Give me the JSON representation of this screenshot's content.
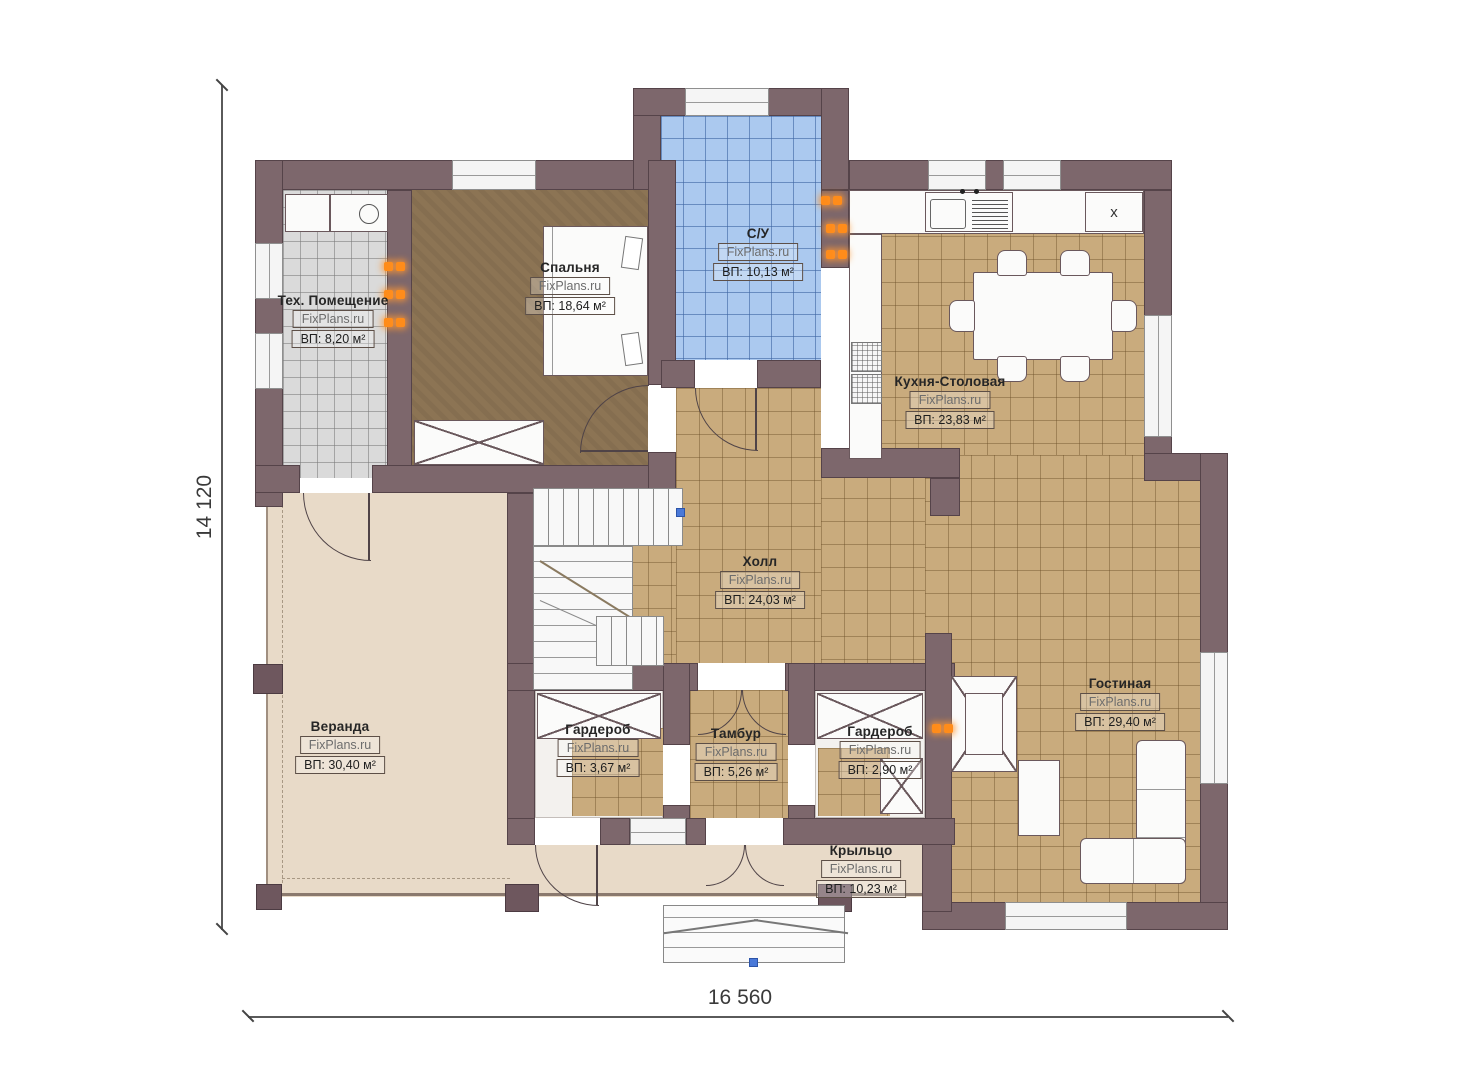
{
  "site_watermark": "FixPlans.ru",
  "dimensions": {
    "vertical": "14 120",
    "horizontal": "16 560"
  },
  "kitchen": {
    "hob_label": "x"
  },
  "rooms": [
    {
      "name": "Тех. Помещение",
      "area": "ВП: 8,20 м²",
      "x": 333,
      "y": 293
    },
    {
      "name": "Спальня",
      "area": "ВП: 18,64 м²",
      "x": 570,
      "y": 260
    },
    {
      "name": "С/У",
      "area": "ВП: 10,13 м²",
      "x": 758,
      "y": 226
    },
    {
      "name": "Кухня-Столовая",
      "area": "ВП: 23,83 м²",
      "x": 950,
      "y": 374
    },
    {
      "name": "Холл",
      "area": "ВП: 24,03 м²",
      "x": 760,
      "y": 554
    },
    {
      "name": "Веранда",
      "area": "ВП: 30,40 м²",
      "x": 340,
      "y": 719
    },
    {
      "name": "Гардероб",
      "area": "ВП: 3,67 м²",
      "x": 598,
      "y": 722
    },
    {
      "name": "Тамбур",
      "area": "ВП: 5,26 м²",
      "x": 736,
      "y": 726
    },
    {
      "name": "Гардероб",
      "area": "ВП: 2,90 м²",
      "x": 880,
      "y": 724
    },
    {
      "name": "Гостиная",
      "area": "ВП: 29,40 м²",
      "x": 1120,
      "y": 676
    },
    {
      "name": "Крыльцо",
      "area": "ВП: 10,23 м²",
      "x": 861,
      "y": 843
    }
  ],
  "colors": {
    "wall": "#7d676c",
    "floor_tile": "#c9ab7d",
    "floor_bath": "#abc9ef",
    "floor_bedroom": "#8c7454",
    "floor_tech": "#dadada",
    "floor_terrace": "#e8dac8",
    "indicator": "#ff8c1a"
  }
}
